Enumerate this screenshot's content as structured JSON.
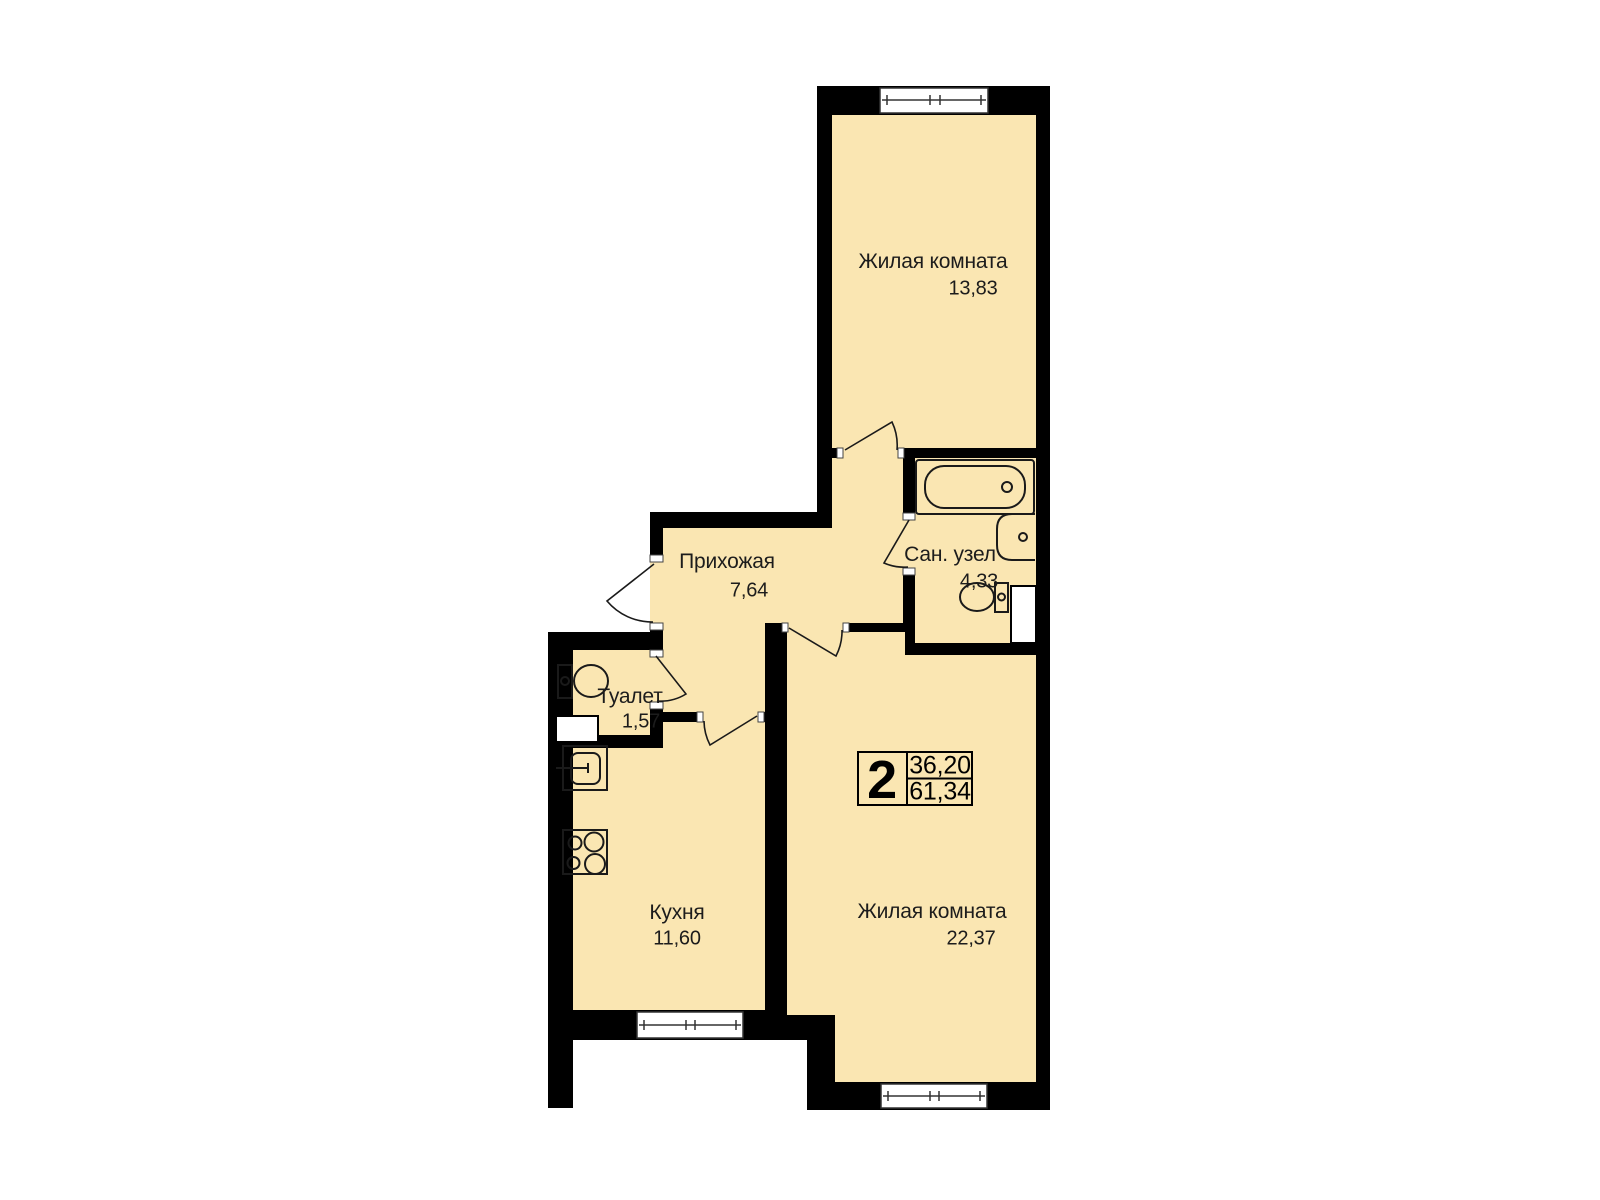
{
  "plan": {
    "type": "apartment-floor-plan",
    "colors": {
      "floor": "#FAE6B2",
      "wall": "#000000",
      "line": "#1a1a1a",
      "background": "#ffffff"
    },
    "rooms": [
      {
        "name": "Жилая комната",
        "area": "13,83"
      },
      {
        "name": "Прихожая",
        "area": "7,64"
      },
      {
        "name": "Сан. узел",
        "area": "4,33"
      },
      {
        "name": "Туалет",
        "area": "1,57"
      },
      {
        "name": "Кухня",
        "area": "11,60"
      },
      {
        "name": "Жилая комната",
        "area": "22,37"
      }
    ],
    "summary": {
      "rooms_count": "2",
      "living_area": "36,20",
      "total_area": "61,34"
    },
    "icons": [
      "bathtub-icon",
      "wash-basin-icon",
      "toilet-icon",
      "wc-toilet-icon",
      "kitchen-sink-icon",
      "stove-icon",
      "vent-shaft",
      "window",
      "door-swing"
    ]
  }
}
